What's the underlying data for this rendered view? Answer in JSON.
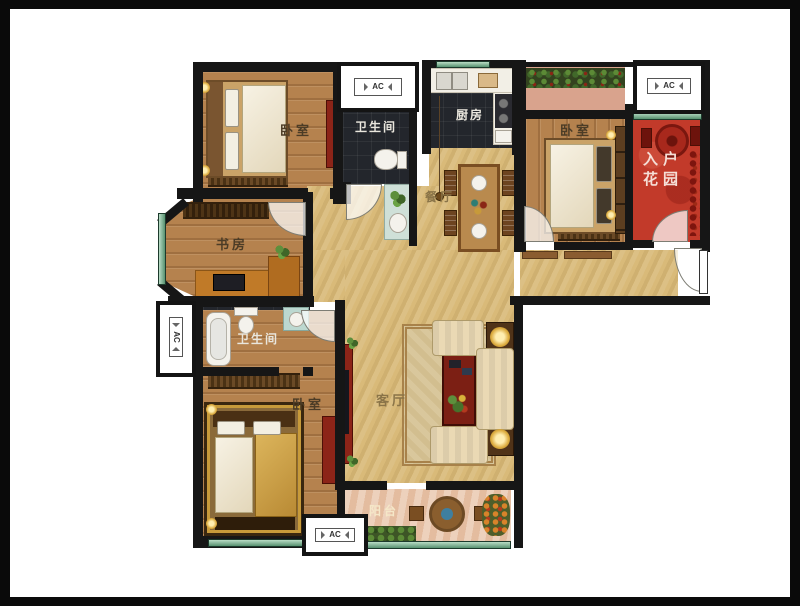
{
  "labels": {
    "bedroom_top_left": "卧室",
    "bath_top": "卫生间",
    "kitchen": "厨房",
    "bedroom_top_right": "卧室",
    "entry_garden_line1": "入户",
    "entry_garden_line2": "花园",
    "dining": "餐厅",
    "study": "书房",
    "bath_left": "卫生间",
    "bedroom_bottom_left": "卧室",
    "living": "客厅",
    "balcony": "阳台",
    "ac": "AC"
  },
  "colors": {
    "wall": "#161616",
    "floor_wood": "#b5824e",
    "floor_tan": "#d9ba79",
    "floor_dark": "#23262c",
    "garden_red": "#c23a2a",
    "balcony_pink": "#e9c6ab",
    "window_green": "#63a183"
  }
}
